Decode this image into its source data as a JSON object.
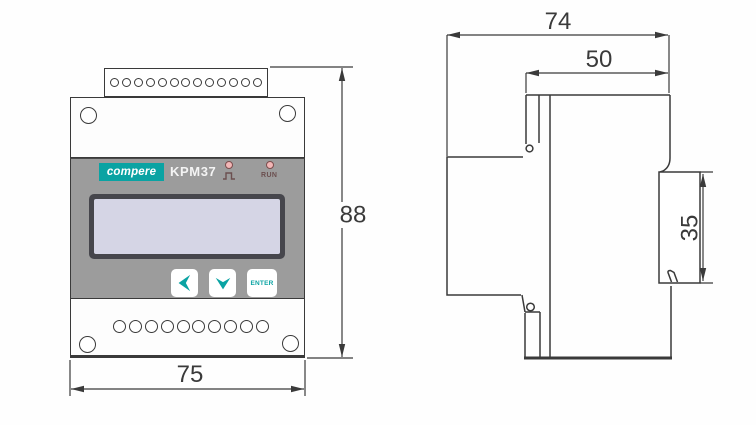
{
  "front_view": {
    "brand": "compere",
    "model": "KPM37",
    "led1": {
      "icon": "pulse"
    },
    "led2": {
      "label": "RUN"
    },
    "buttons": {
      "enter_label": "ENTER"
    },
    "top_terminal_count": 13,
    "bottom_terminal_count": 10,
    "dimensions": {
      "width_mm": "75",
      "height_mm": "88"
    }
  },
  "side_view": {
    "dimensions": {
      "overall_depth_mm": "74",
      "body_depth_mm": "50",
      "din_rail_mm": "35"
    }
  },
  "colors": {
    "accent_teal": "#0aa3a3",
    "face_gray": "#9c9c9c",
    "lcd_screen": "#d5d5e5",
    "led_pink": "#f2b6b6",
    "line": "#3a3a3a"
  }
}
